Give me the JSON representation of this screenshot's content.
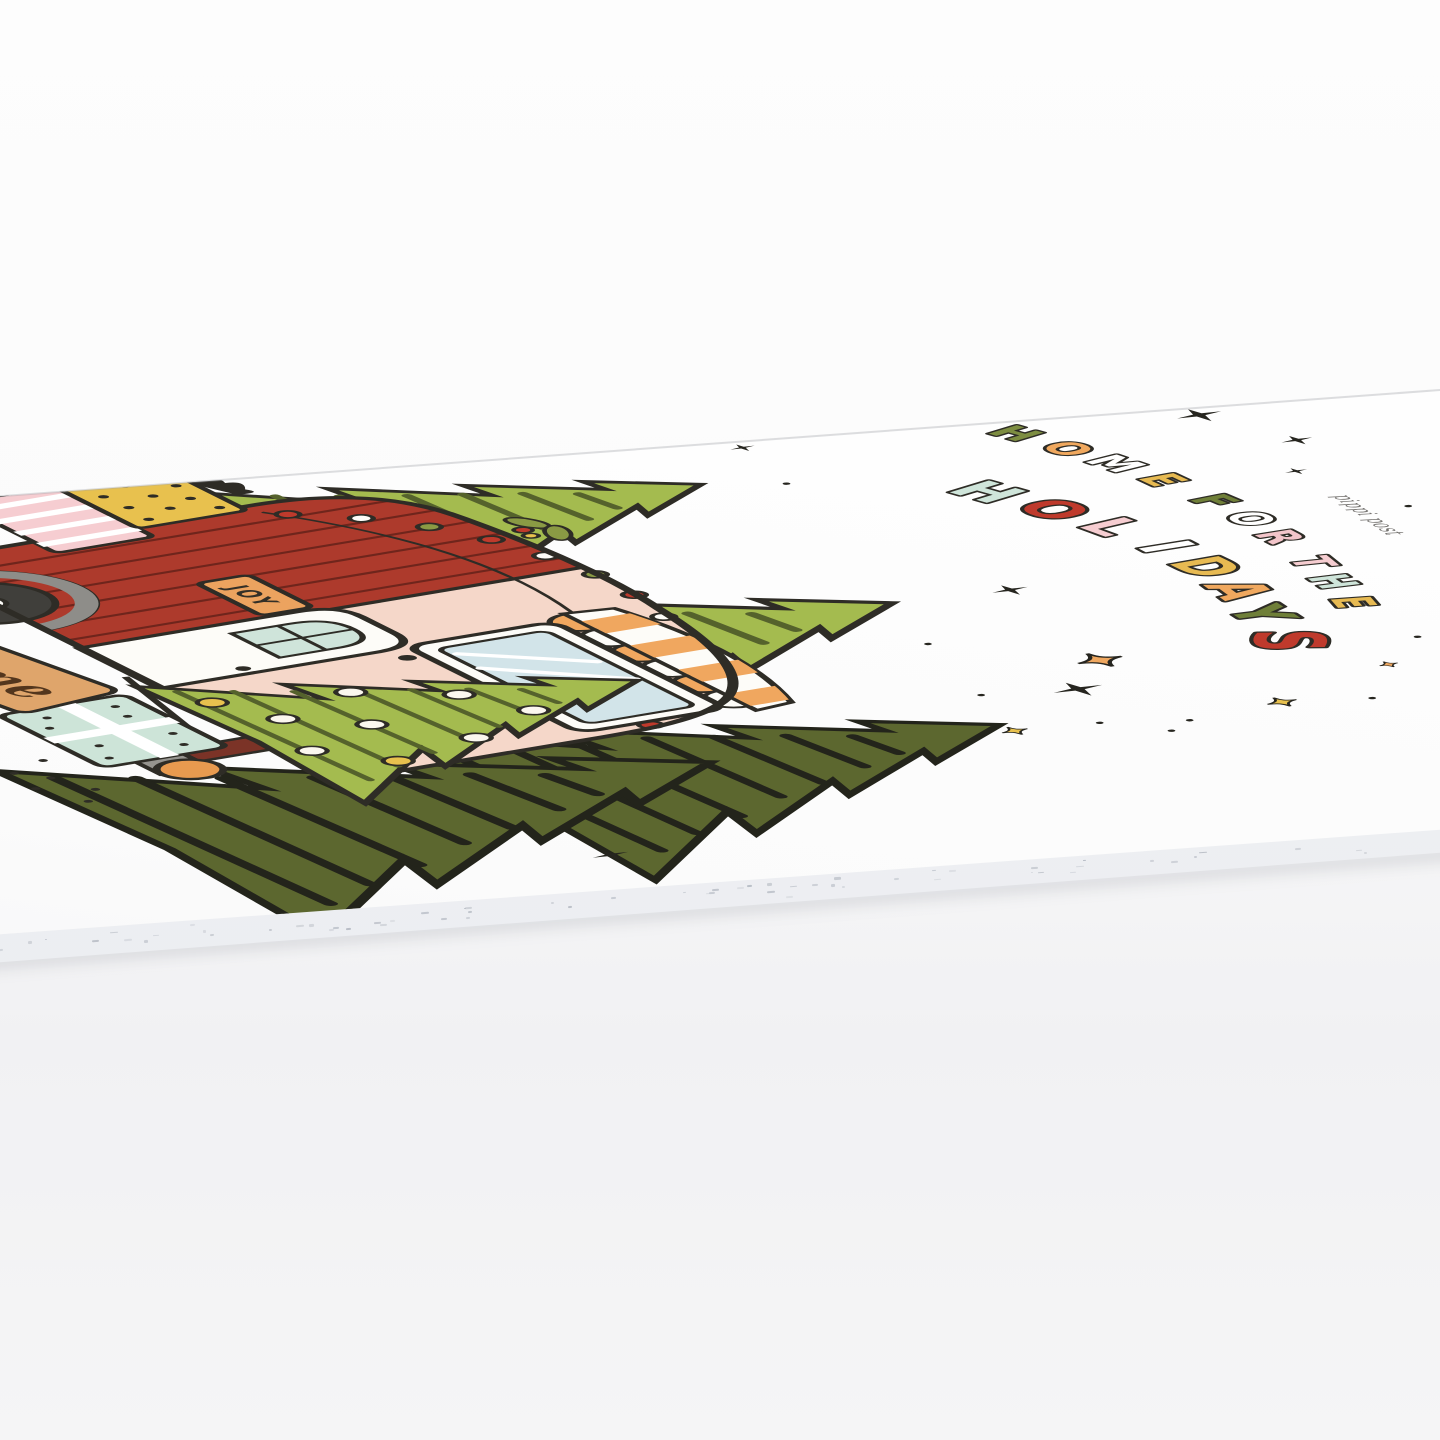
{
  "photo_alt": "Holiday notepad lying flat on a white surface, viewed at a low oblique angle; cover art shows a vintage camper among pine trees with gifts and stars",
  "title": {
    "line1": [
      {
        "ch": "H",
        "color": "#7d8d41"
      },
      {
        "ch": "O",
        "color": "#f0a85e"
      },
      {
        "ch": "M",
        "color": "#ffffff"
      },
      {
        "ch": "E",
        "color": "#e7ba52"
      },
      {
        "ch": "F",
        "color": "#6f7f38"
      },
      {
        "ch": "O",
        "color": "#ffffff"
      },
      {
        "ch": "R",
        "color": "#f3c5ca"
      },
      {
        "ch": "T",
        "color": "#f6cdd1"
      },
      {
        "ch": "H",
        "color": "#cfe5da"
      },
      {
        "ch": "E",
        "color": "#e7ba52"
      }
    ],
    "line2": [
      {
        "ch": "H",
        "color": "#cfe5da"
      },
      {
        "ch": "O",
        "color": "#bf3a2c"
      },
      {
        "ch": "L",
        "color": "#f6cdd1"
      },
      {
        "ch": "I",
        "color": "#ffffff"
      },
      {
        "ch": "D",
        "color": "#e7ba52"
      },
      {
        "ch": "A",
        "color": "#f0a85e"
      },
      {
        "ch": "Y",
        "color": "#6f7f38"
      },
      {
        "ch": "S",
        "color": "#bf3a2c"
      }
    ]
  },
  "signs": {
    "joy": "JOY",
    "home": "home"
  },
  "brand_script": "pippi post",
  "palette": {
    "background": "#fbfbfb",
    "card": "#fefefe",
    "page_edge": "#eef0f3",
    "outline": "#2e2c26",
    "camper_pink": "#f5d7c9",
    "camper_red": "#ad3a2c",
    "plank_line": "#6f251c",
    "awning_orange": "#f0a75f",
    "trim_white": "#fdfcf8",
    "window_blue": "#d2e4e9",
    "door_mint": "#cfe4da",
    "joy_bg": "#eca35f",
    "joy_text": "#332f27",
    "wheel_dark": "#403f3b",
    "fender_gray": "#8e8d89",
    "tree_light": "#a4bb4f",
    "tree_light_hatch": "#55622c",
    "tree_dark": "#5c672f",
    "tree_dark_hatch": "#23241b",
    "trunk_brown": "#7b3327",
    "stand_gray": "#96948f",
    "gift_yellow": "#e8c14e",
    "gift_pink": "#f6cdd1",
    "gift_red": "#c0392b",
    "gift_mint": "#cde4d8",
    "ball_orange": "#e89a4f",
    "sign_tan": "#dfa56b",
    "script_brown": "#53361d",
    "brand_gray": "#757370",
    "star_yellow": "#e8c14e",
    "star_orange": "#efa75f",
    "light_red": "#bf3a2c",
    "light_green": "#8a9a44"
  }
}
